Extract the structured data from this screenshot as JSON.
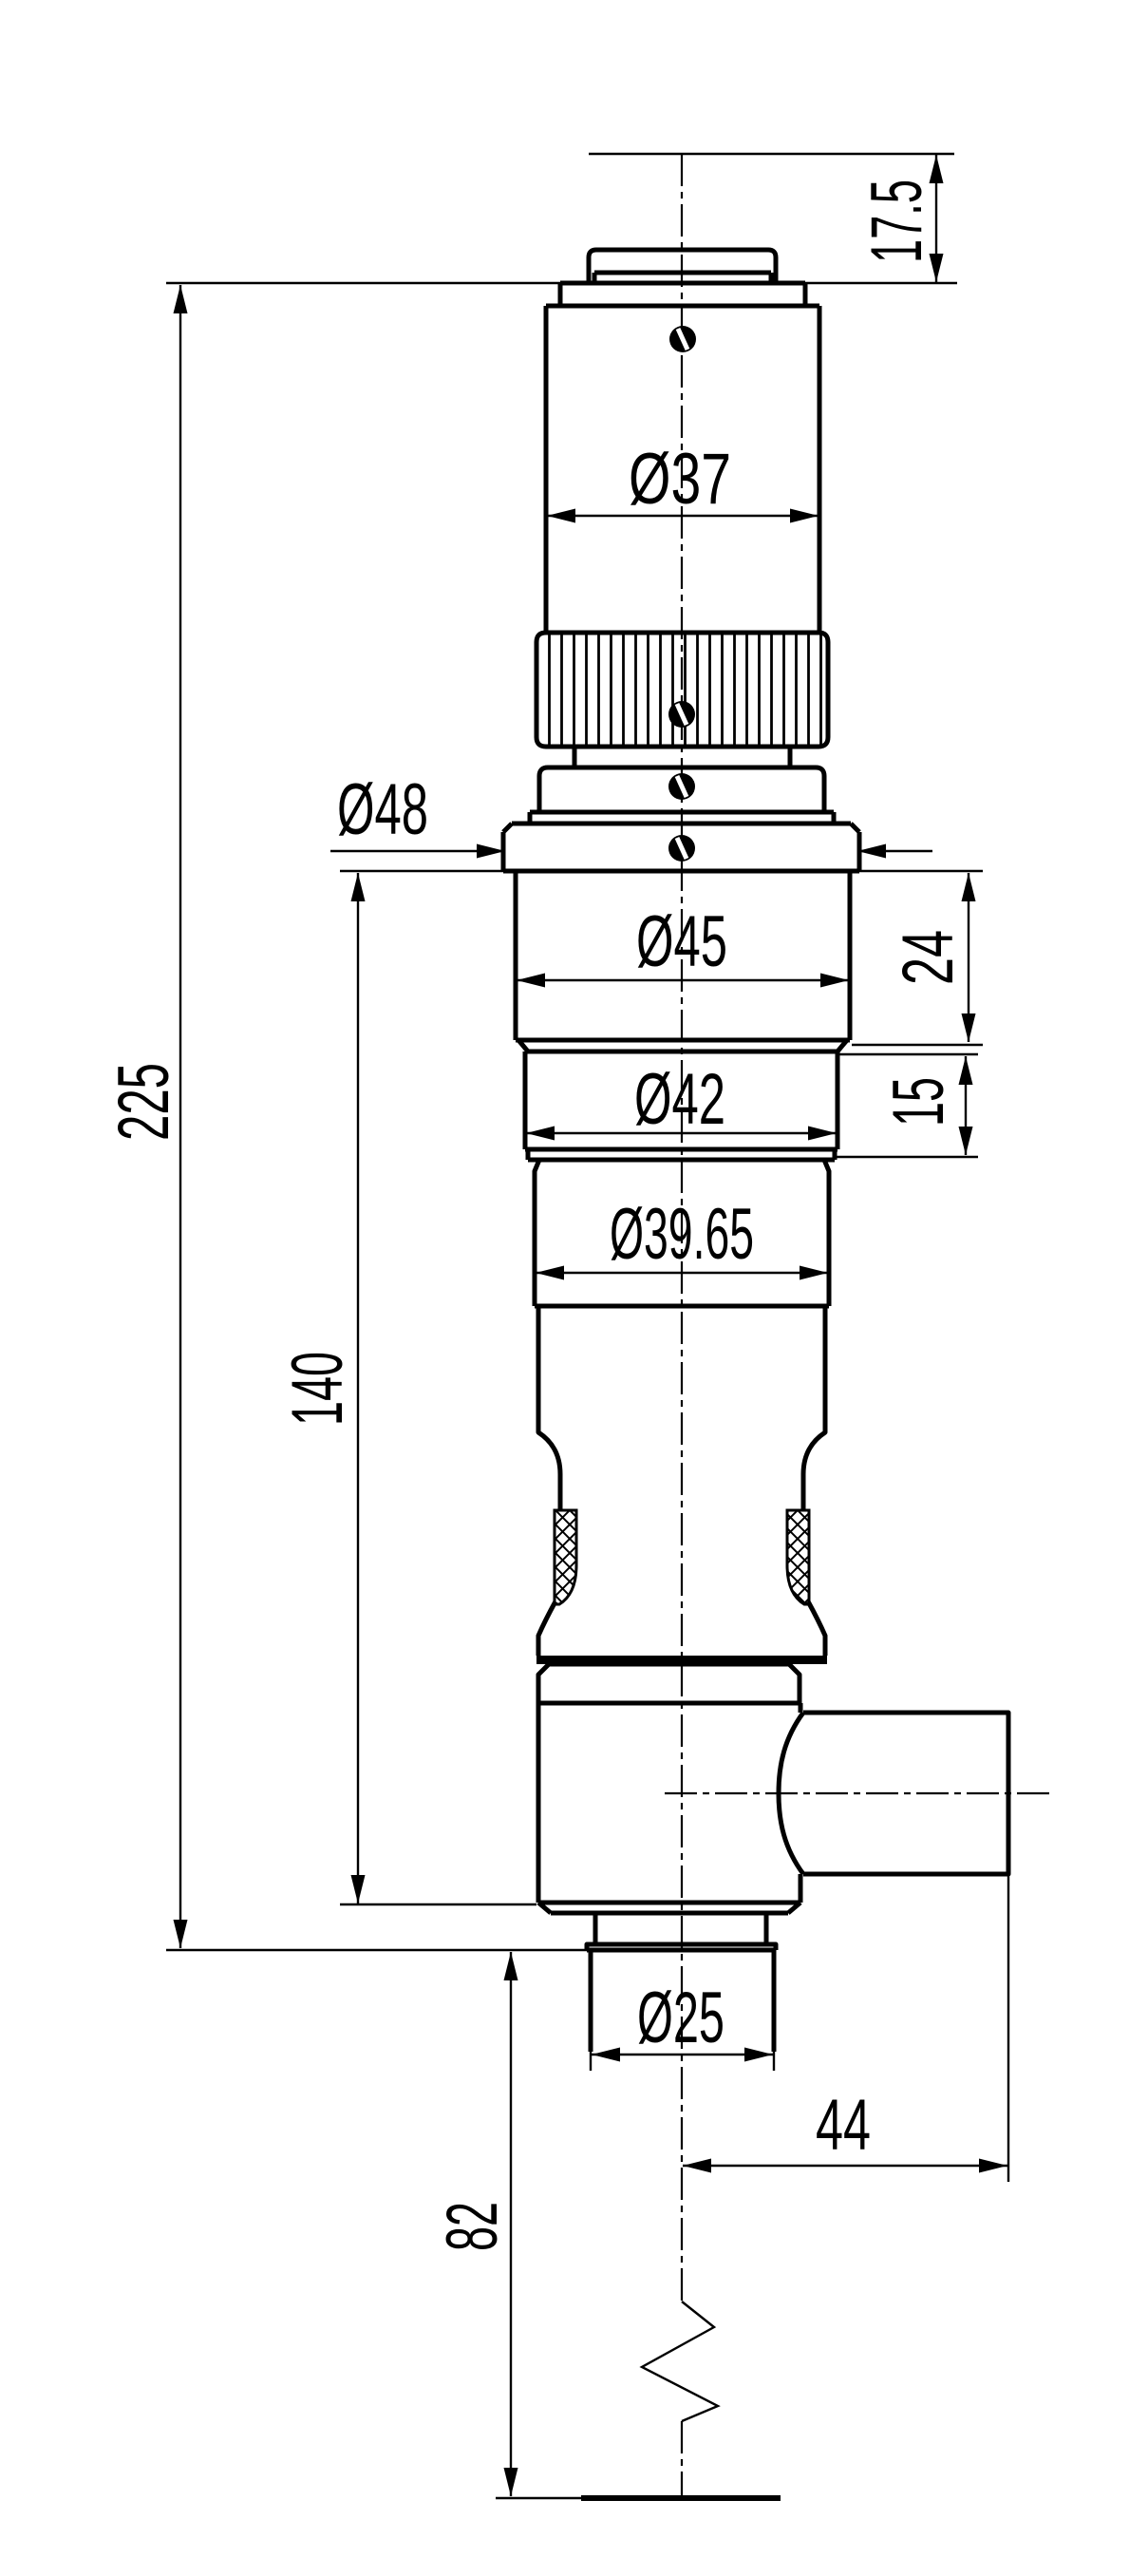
{
  "drawing": {
    "kind": "technical-dimension-drawing",
    "dimensions": {
      "top_offset": "17.5",
      "upper_body_diameter": "Ø37",
      "flange_diameter": "Ø48",
      "section45_diameter": "Ø45",
      "section45_length": "24",
      "section42_diameter": "Ø42",
      "section42_length": "15",
      "section3965_diameter": "Ø39.65",
      "overall_length": "225",
      "lower_assembly_length": "140",
      "nose_diameter": "Ø25",
      "side_port_offset": "44",
      "bottom_extension": "82"
    }
  }
}
